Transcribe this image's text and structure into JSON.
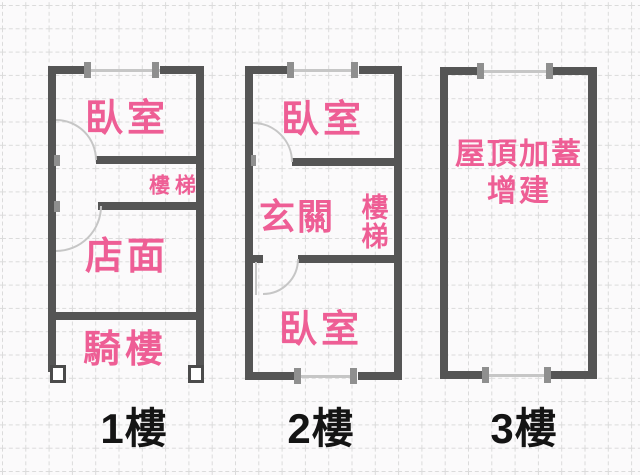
{
  "colors": {
    "wall": "#555555",
    "room_label": "#ee5e95",
    "floor_label": "#141414",
    "grid_line": "#dbdbdb",
    "window_line": "#c6c6c6",
    "background": "#fbfafb"
  },
  "floors": [
    {
      "id": "floor-1",
      "floor_label": "1樓",
      "rooms": {
        "bedroom": "臥室",
        "stairs": "樓梯",
        "storefront": "店面",
        "arcade": "騎樓"
      }
    },
    {
      "id": "floor-2",
      "floor_label": "2樓",
      "rooms": {
        "bedroom_front": "臥室",
        "foyer": "玄關",
        "stairs": "樓梯",
        "bedroom_back": "臥室"
      }
    },
    {
      "id": "floor-3",
      "floor_label": "3樓",
      "rooms": {
        "rooftop_line1": "屋頂加蓋",
        "rooftop_line2": "增建"
      }
    }
  ]
}
